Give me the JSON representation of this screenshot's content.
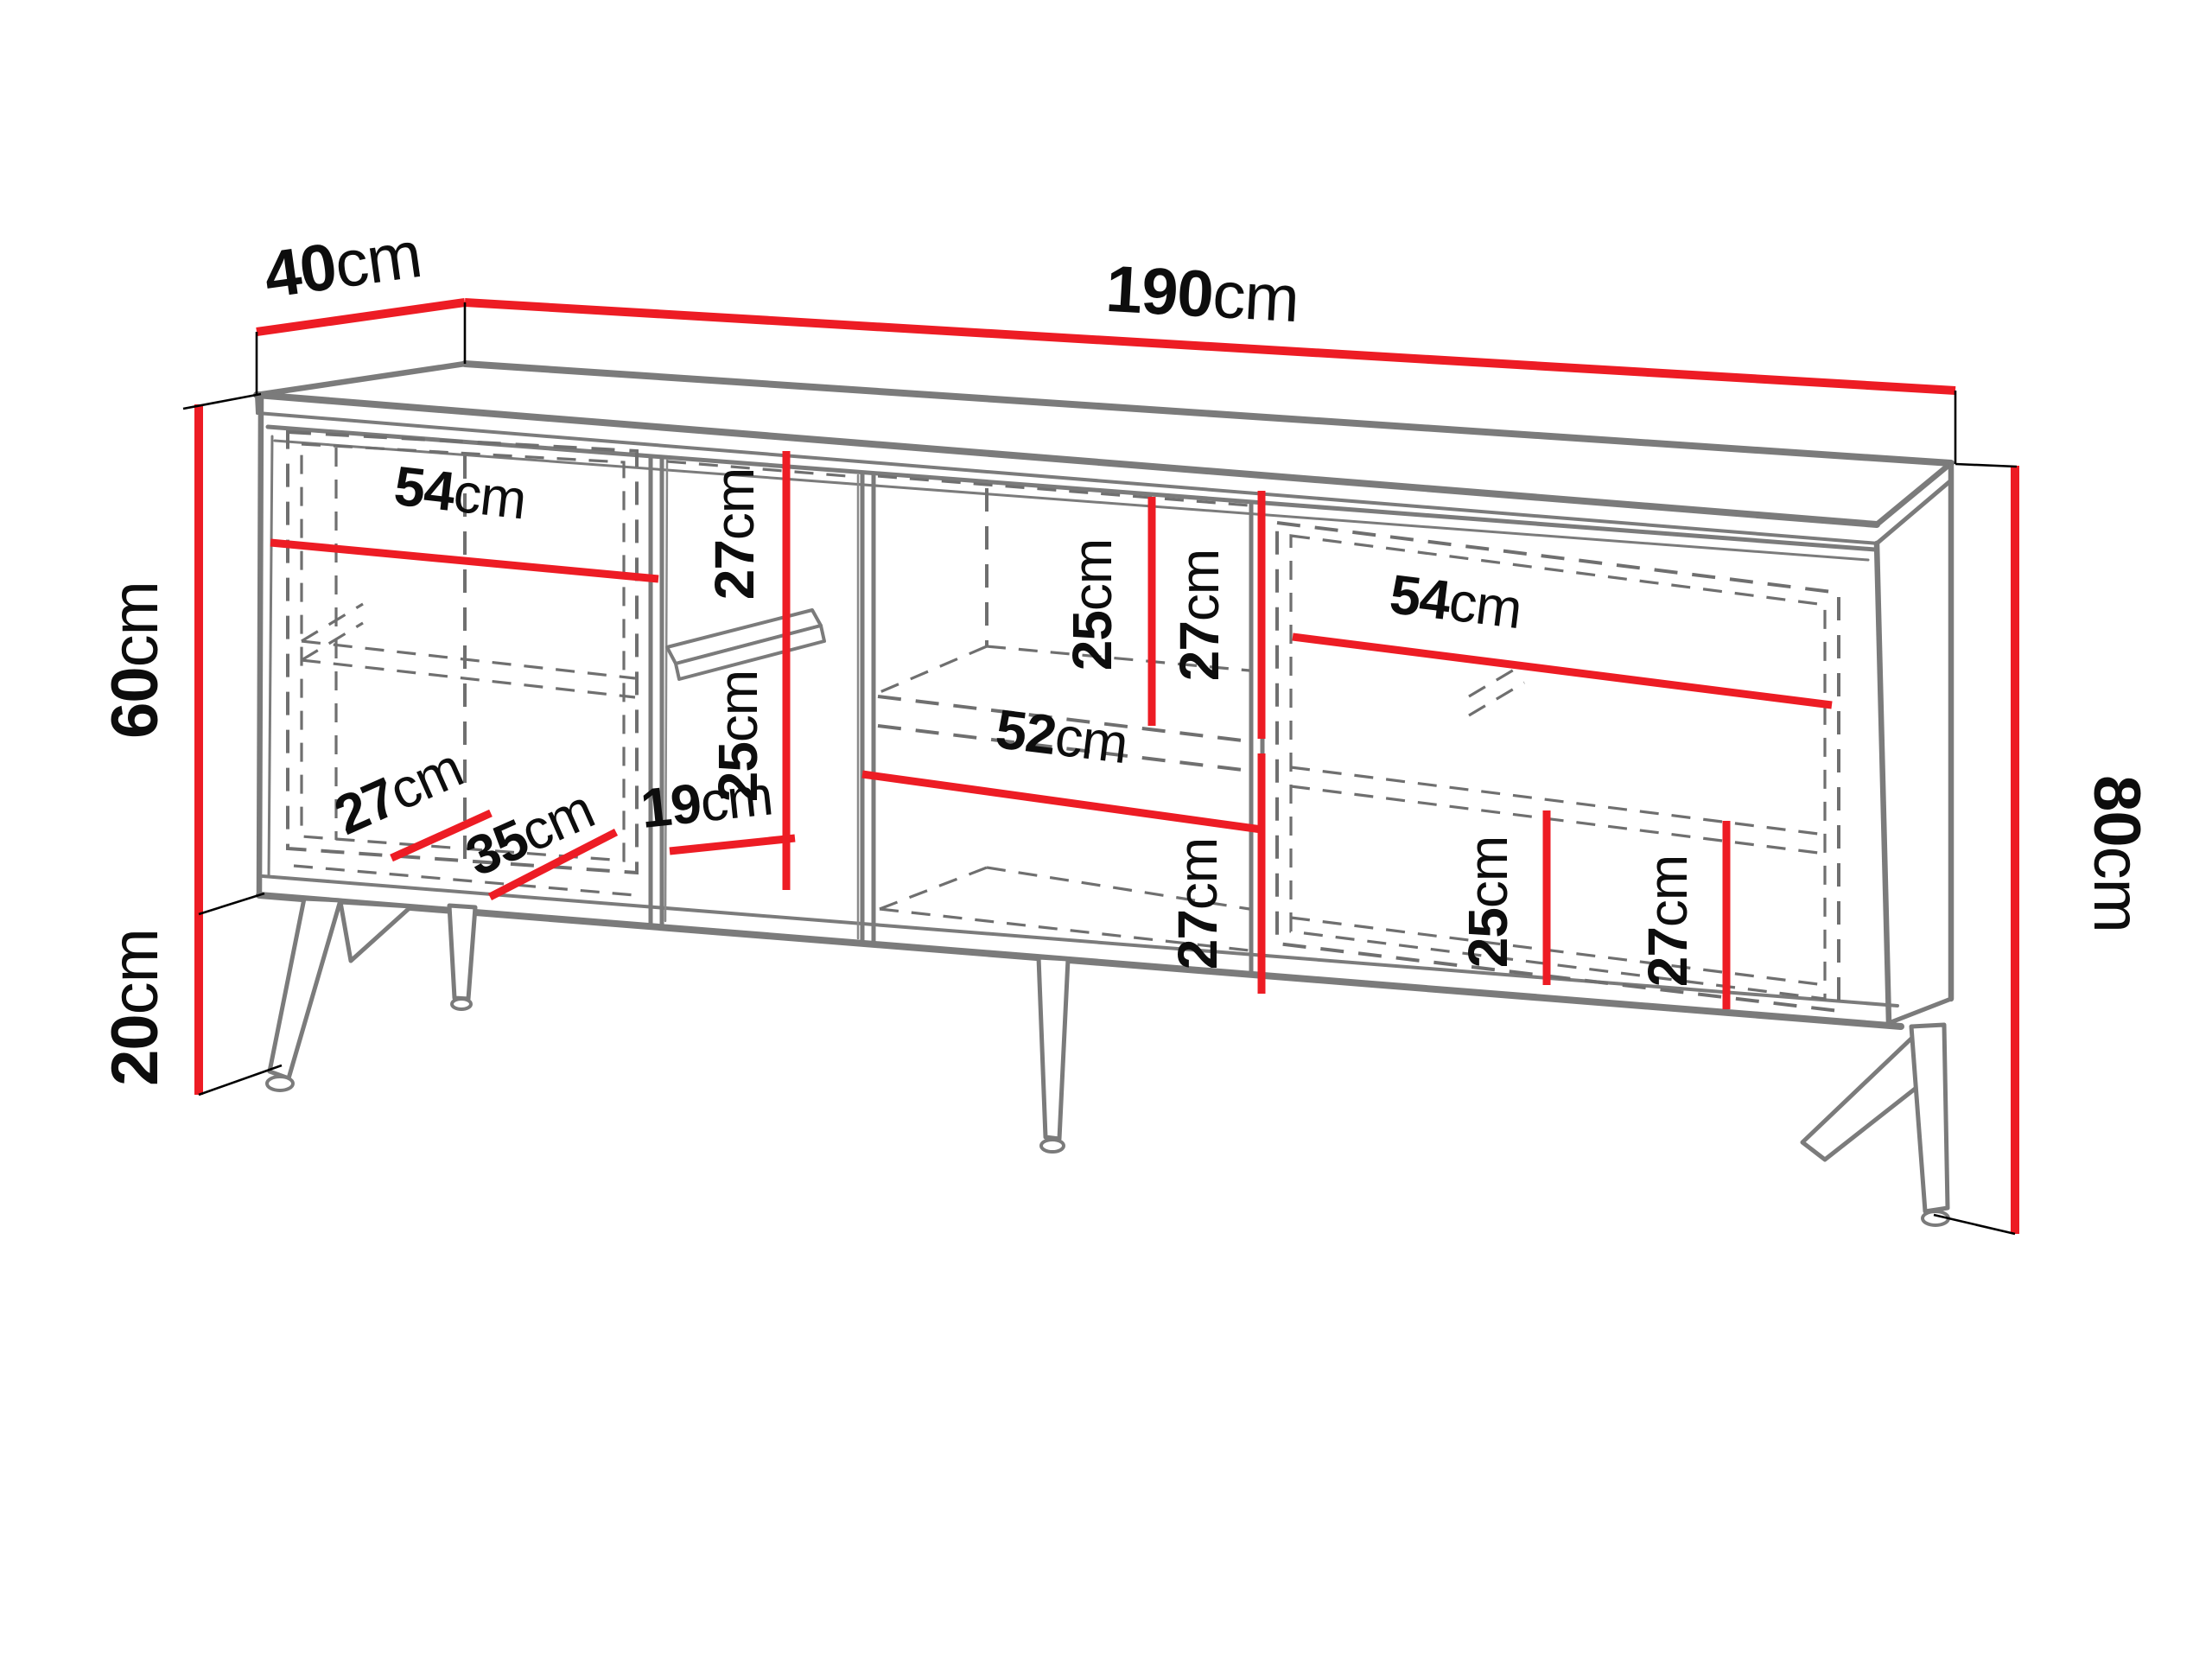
{
  "diagram_type": "furniture-dimension-drawing",
  "subject": "sideboard cabinet with four sections, shelves and metal legs",
  "style": {
    "dimension_color": "#ed1c24",
    "outline_color": "#7b7b7b",
    "dashed_color": "#6f6f6f",
    "text_color": "#0d0d0d",
    "background": "#ffffff"
  },
  "dims": {
    "depth": {
      "value": "40",
      "unit": "cm"
    },
    "width": {
      "value": "190",
      "unit": "cm"
    },
    "carcass_height": {
      "value": "60",
      "unit": "cm"
    },
    "leg_height": {
      "value": "20",
      "unit": "cm"
    },
    "total_height": {
      "value": "80",
      "unit": "cm"
    },
    "left_section_width": {
      "value": "54",
      "unit": "cm"
    },
    "left_depth_back": {
      "value": "27",
      "unit": "cm"
    },
    "left_depth_front": {
      "value": "35",
      "unit": "cm"
    },
    "niche_upper_height": {
      "value": "27",
      "unit": "cm"
    },
    "niche_lower_height": {
      "value": "25",
      "unit": "cm"
    },
    "niche_width": {
      "value": "19",
      "unit": "cm"
    },
    "middle_upper_left_height": {
      "value": "25",
      "unit": "cm"
    },
    "middle_upper_right_height": {
      "value": "27",
      "unit": "cm"
    },
    "middle_width": {
      "value": "52",
      "unit": "cm"
    },
    "middle_lower_height": {
      "value": "27",
      "unit": "cm"
    },
    "right_section_width": {
      "value": "54",
      "unit": "cm"
    },
    "right_lower_left_height": {
      "value": "25",
      "unit": "cm"
    },
    "right_lower_right_height": {
      "value": "27",
      "unit": "cm"
    }
  }
}
